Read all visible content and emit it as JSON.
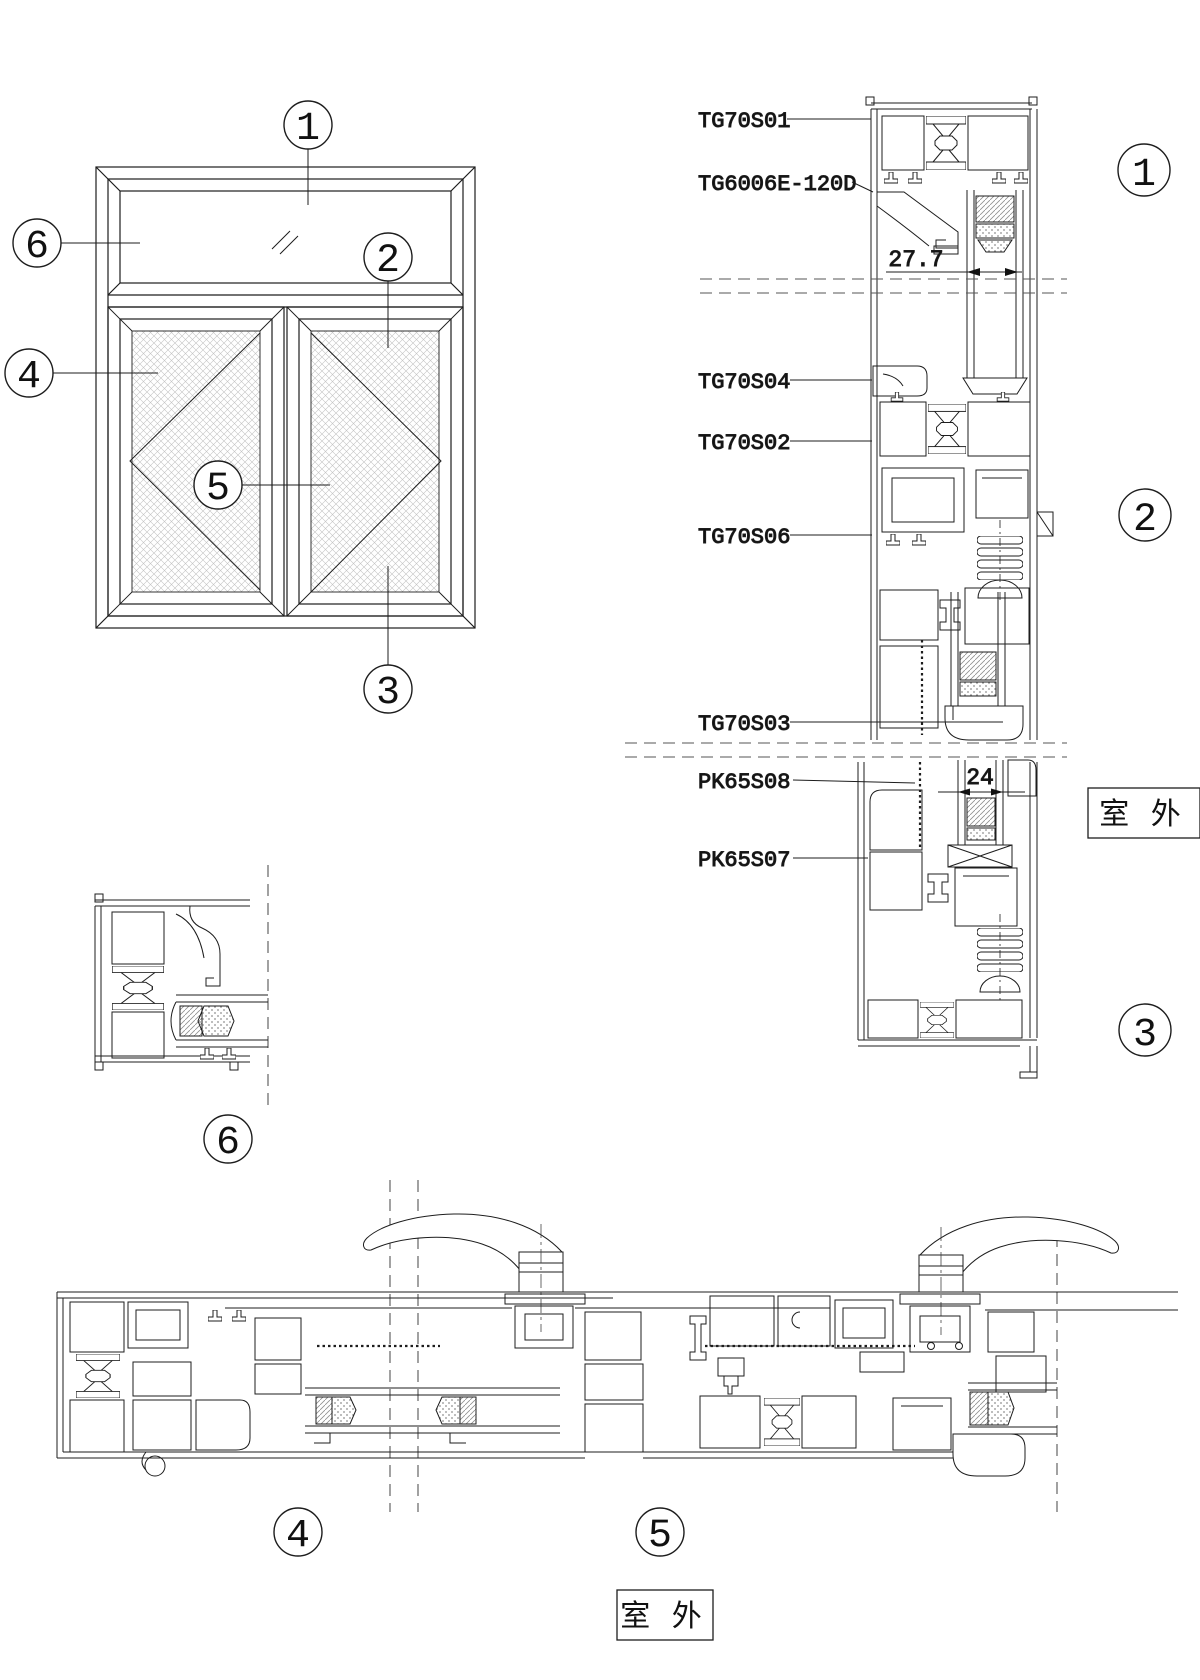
{
  "drawing_type": "aluminum-window-section-details",
  "colors": {
    "line": "#1d1d1d",
    "dash": "#555555",
    "hatch": "#a8a8a8",
    "bg": "#ffffff"
  },
  "elevation": {
    "callouts": [
      "1",
      "6",
      "2",
      "4",
      "5",
      "3"
    ]
  },
  "vertical_section": {
    "part_labels": [
      "TG70S01",
      "TG6006E-120D",
      "TG70S04",
      "TG70S02",
      "TG70S06",
      "TG70S03",
      "PK65S08",
      "PK65S07"
    ],
    "dimensions": [
      "27.7",
      "24"
    ],
    "outdoor_label": "室 外",
    "callouts": [
      "1",
      "2",
      "3"
    ]
  },
  "detail6": {
    "callout": "6"
  },
  "horizontal_section": {
    "callouts": [
      "4",
      "5"
    ],
    "outdoor_label": "室 外"
  }
}
